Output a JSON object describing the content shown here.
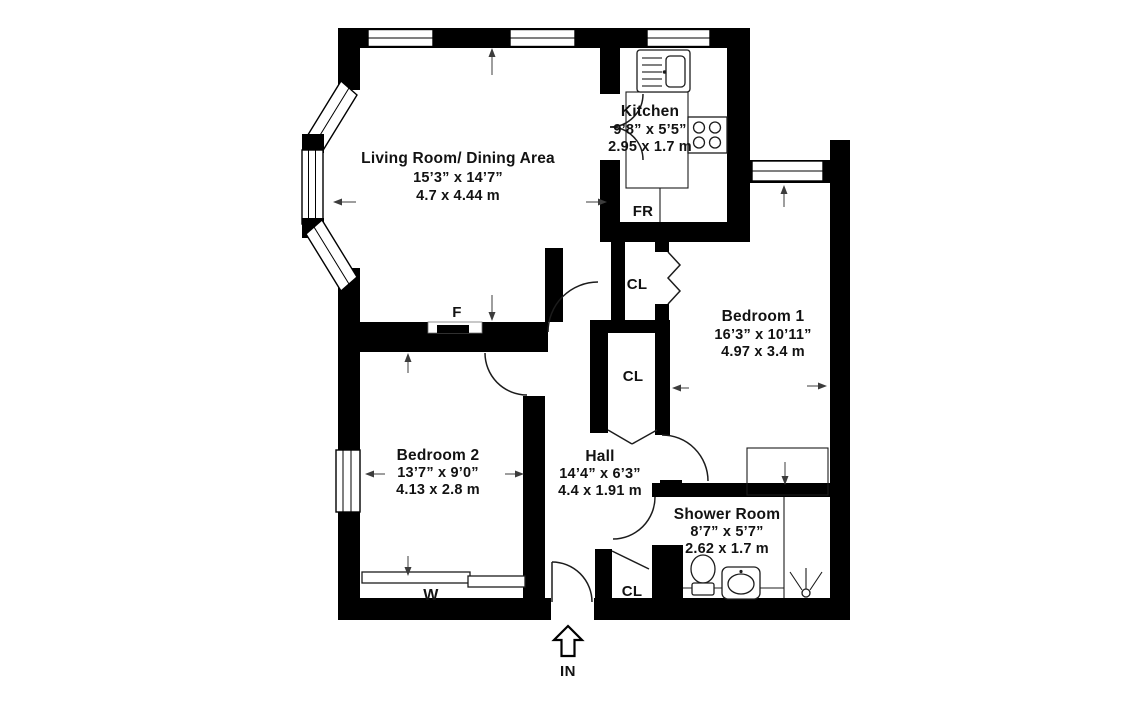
{
  "plan": {
    "rooms": {
      "living": {
        "name": "Living Room/ Dining Area",
        "imperial": "15’3” x 14’7”",
        "metric": "4.7 x 4.44 m"
      },
      "kitchen": {
        "name": "Kitchen",
        "imperial": "9’8” x 5’5”",
        "metric": "2.95 x 1.7 m"
      },
      "bedroom1": {
        "name": "Bedroom 1",
        "imperial": "16’3” x 10’11”",
        "metric": "4.97 x 3.4 m"
      },
      "bedroom2": {
        "name": "Bedroom 2",
        "imperial": "13’7” x 9’0”",
        "metric": "4.13 x 2.8 m"
      },
      "hall": {
        "name": "Hall",
        "imperial": "14’4” x 6’3”",
        "metric": "4.4 x 1.91 m"
      },
      "shower": {
        "name": "Shower Room",
        "imperial": "8’7” x 5’7”",
        "metric": "2.62 x 1.7 m"
      }
    },
    "labels": {
      "closet": "CL",
      "fridge": "FR",
      "fireplace": "F",
      "wardrobe": "W",
      "entrance": "IN"
    },
    "fixture_icons": [
      "sink-icon",
      "stove-icon",
      "toilet-icon",
      "basin-icon",
      "shower-head-icon",
      "entrance-arrow-icon"
    ],
    "colors": {
      "wall": "#000000",
      "background": "#ffffff",
      "line": "#1c1c1c",
      "dimension": "#3c3c3c"
    }
  }
}
